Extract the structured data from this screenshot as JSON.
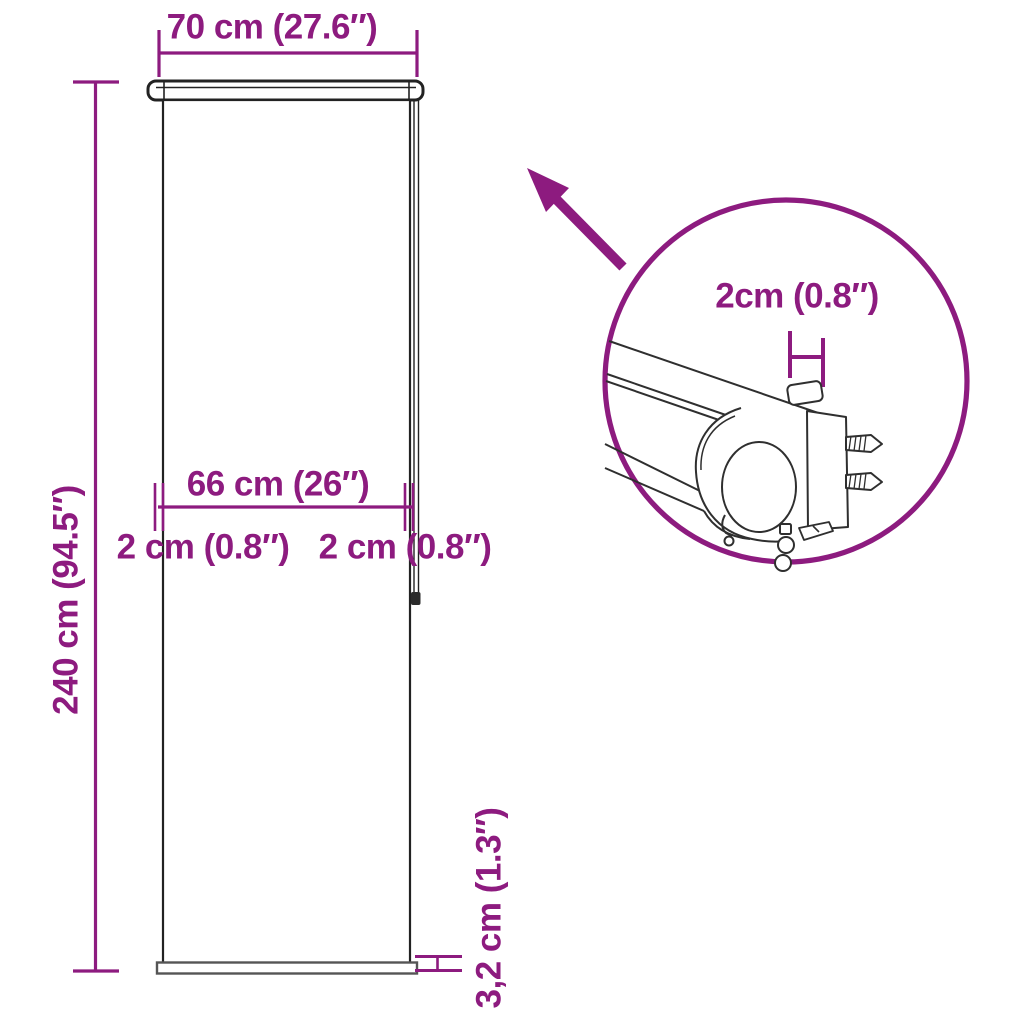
{
  "image": {
    "title": "Roller blind dimension diagram",
    "accent_color": "#8d1b7f",
    "line_color": "#222222"
  },
  "labels": {
    "total_width": "70 cm (27.6″)",
    "total_height": "240 cm (94.5″)",
    "inner_width": "66 cm (26″)",
    "left_bracket_offset": "2 cm (0.8″)",
    "right_bracket_offset": "2 cm (0.8″)",
    "bottom_bar_height": "3,2 cm (1.3″)",
    "detail_bracket_depth": "2cm (0.8″)"
  }
}
